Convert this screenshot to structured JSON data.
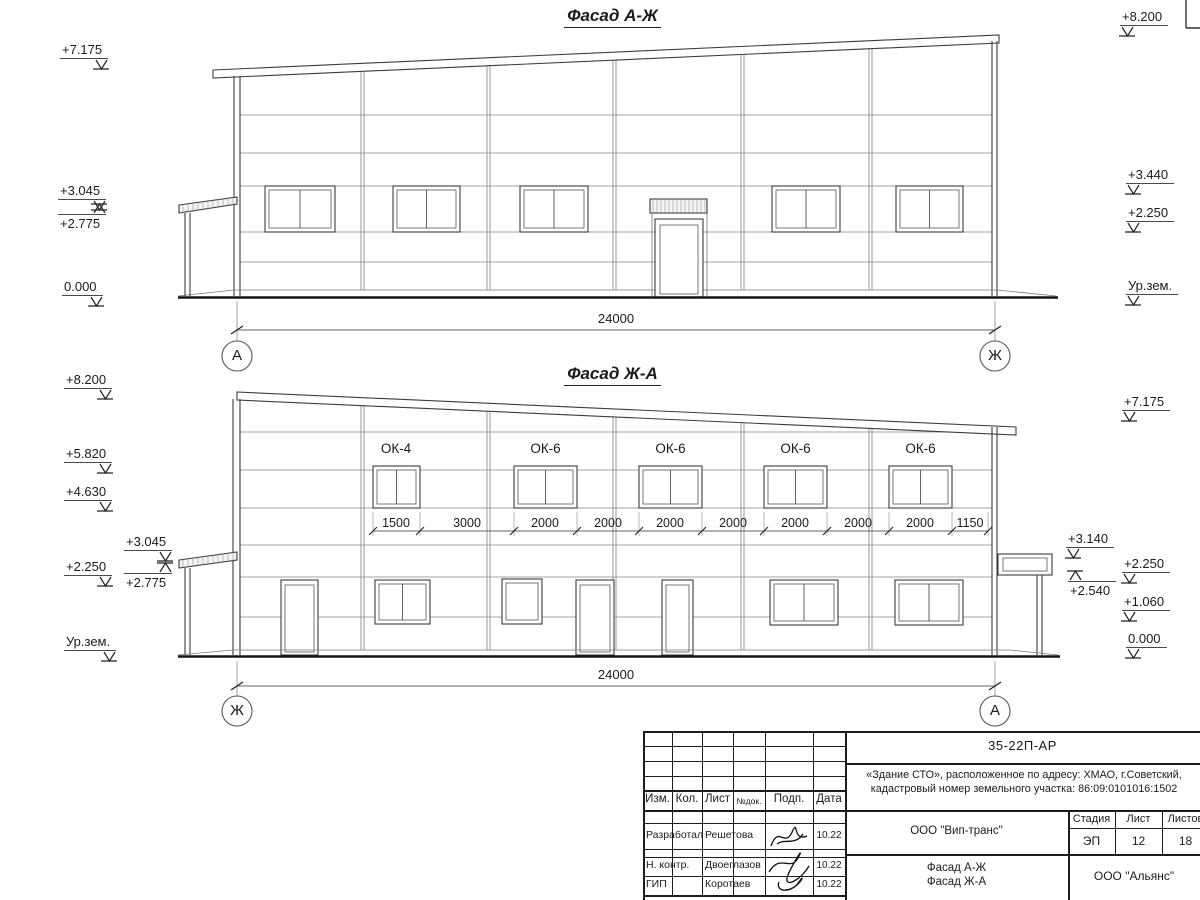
{
  "drawing": {
    "facade_top": {
      "title": "Фасад А-Ж",
      "axis_left": "А",
      "axis_right": "Ж",
      "overall_dim": "24000",
      "marks_left": [
        "+7.175",
        "+3.045",
        "+2.775",
        "0.000"
      ],
      "marks_right": [
        "+8.200",
        "+3.440",
        "+2.250",
        "Ур.зем."
      ]
    },
    "facade_bottom": {
      "title": "Фасад Ж-А",
      "axis_left": "Ж",
      "axis_right": "А",
      "overall_dim": "24000",
      "marks_left": [
        "+8.200",
        "+5.820",
        "+4.630",
        "+3.045",
        "+2.250",
        "+2.775",
        "Ур.зем."
      ],
      "marks_right": [
        "+7.175",
        "+3.140",
        "+2.540",
        "+2.250",
        "+1.060",
        "0.000"
      ],
      "window_labels": [
        "ОК-4",
        "ОК-6",
        "ОК-6",
        "ОК-6",
        "ОК-6"
      ],
      "window_dims": [
        "1500",
        "3000",
        "2000",
        "2000",
        "2000",
        "2000",
        "2000",
        "2000",
        "2000",
        "1150"
      ]
    }
  },
  "titleblock": {
    "doc_number": "35-22П-АР",
    "project_line1": "«Здание СТО», расположенное по адресу: ХМАО, г.Советский,",
    "project_line2": "кадастровый номер земельного участка: 86:09:0101016:1502",
    "columns": {
      "izm": "Изм.",
      "kol": "Кол.",
      "list": "Лист",
      "ndok": "№док.",
      "podp": "Подп.",
      "data": "Дата"
    },
    "rows": [
      {
        "role": "Разработал",
        "name": "Решетова",
        "date": "10.22"
      },
      {
        "role": "Н. контр.",
        "name": "Двоеглазов",
        "date": "10.22"
      },
      {
        "role": "ГИП",
        "name": "Коротаев",
        "date": "10.22"
      }
    ],
    "client": "ООО \"Вип-транс\"",
    "stage_label": "Стадия",
    "sheet_label": "Лист",
    "sheets_label": "Листов",
    "stage": "ЭП",
    "sheet": "12",
    "sheets": "18",
    "sheet_title_line1": "Фасад А-Ж",
    "sheet_title_line2": "Фасад Ж-А",
    "company": "ООО \"Альянс\""
  }
}
